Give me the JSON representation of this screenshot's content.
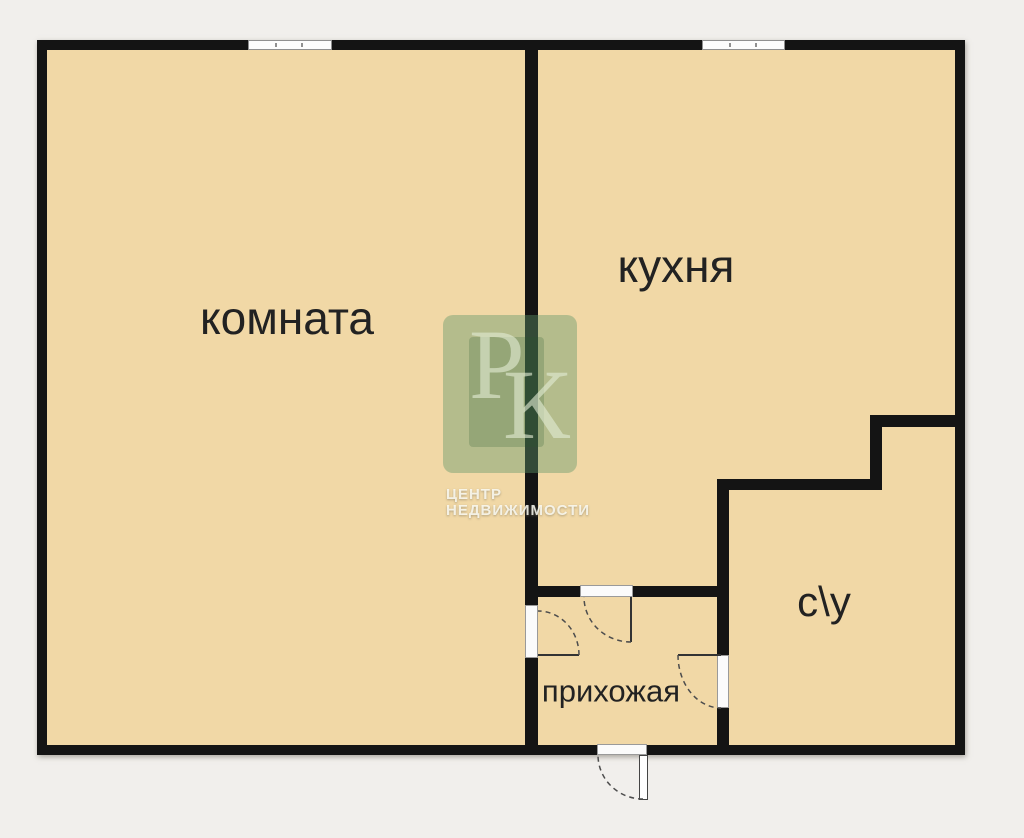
{
  "plan": {
    "type": "apartment-floor-plan",
    "language": "ru"
  },
  "rooms": {
    "living_room": {
      "label": "комната"
    },
    "kitchen": {
      "label": "кухня"
    },
    "bathroom": {
      "label": "с\\у"
    },
    "hallway": {
      "label": "прихожая"
    }
  },
  "watermark": {
    "monogram": {
      "letter_p": "Р",
      "letter_k": "К"
    },
    "caption_line1": "ЦЕНТР",
    "caption_line2": "НЕДВИЖИМОСТИ"
  },
  "colors": {
    "background": "#f1efec",
    "floor": "#f1d8a6",
    "wall": "#141414",
    "window_fill": "#fcfcfc",
    "window_edge": "#8f8f8f",
    "door_arc": "#4d4d4d",
    "label_text": "#222222",
    "watermark_green": "rgba(95,150,105,0.42)",
    "watermark_text": "#fcfcf4"
  }
}
